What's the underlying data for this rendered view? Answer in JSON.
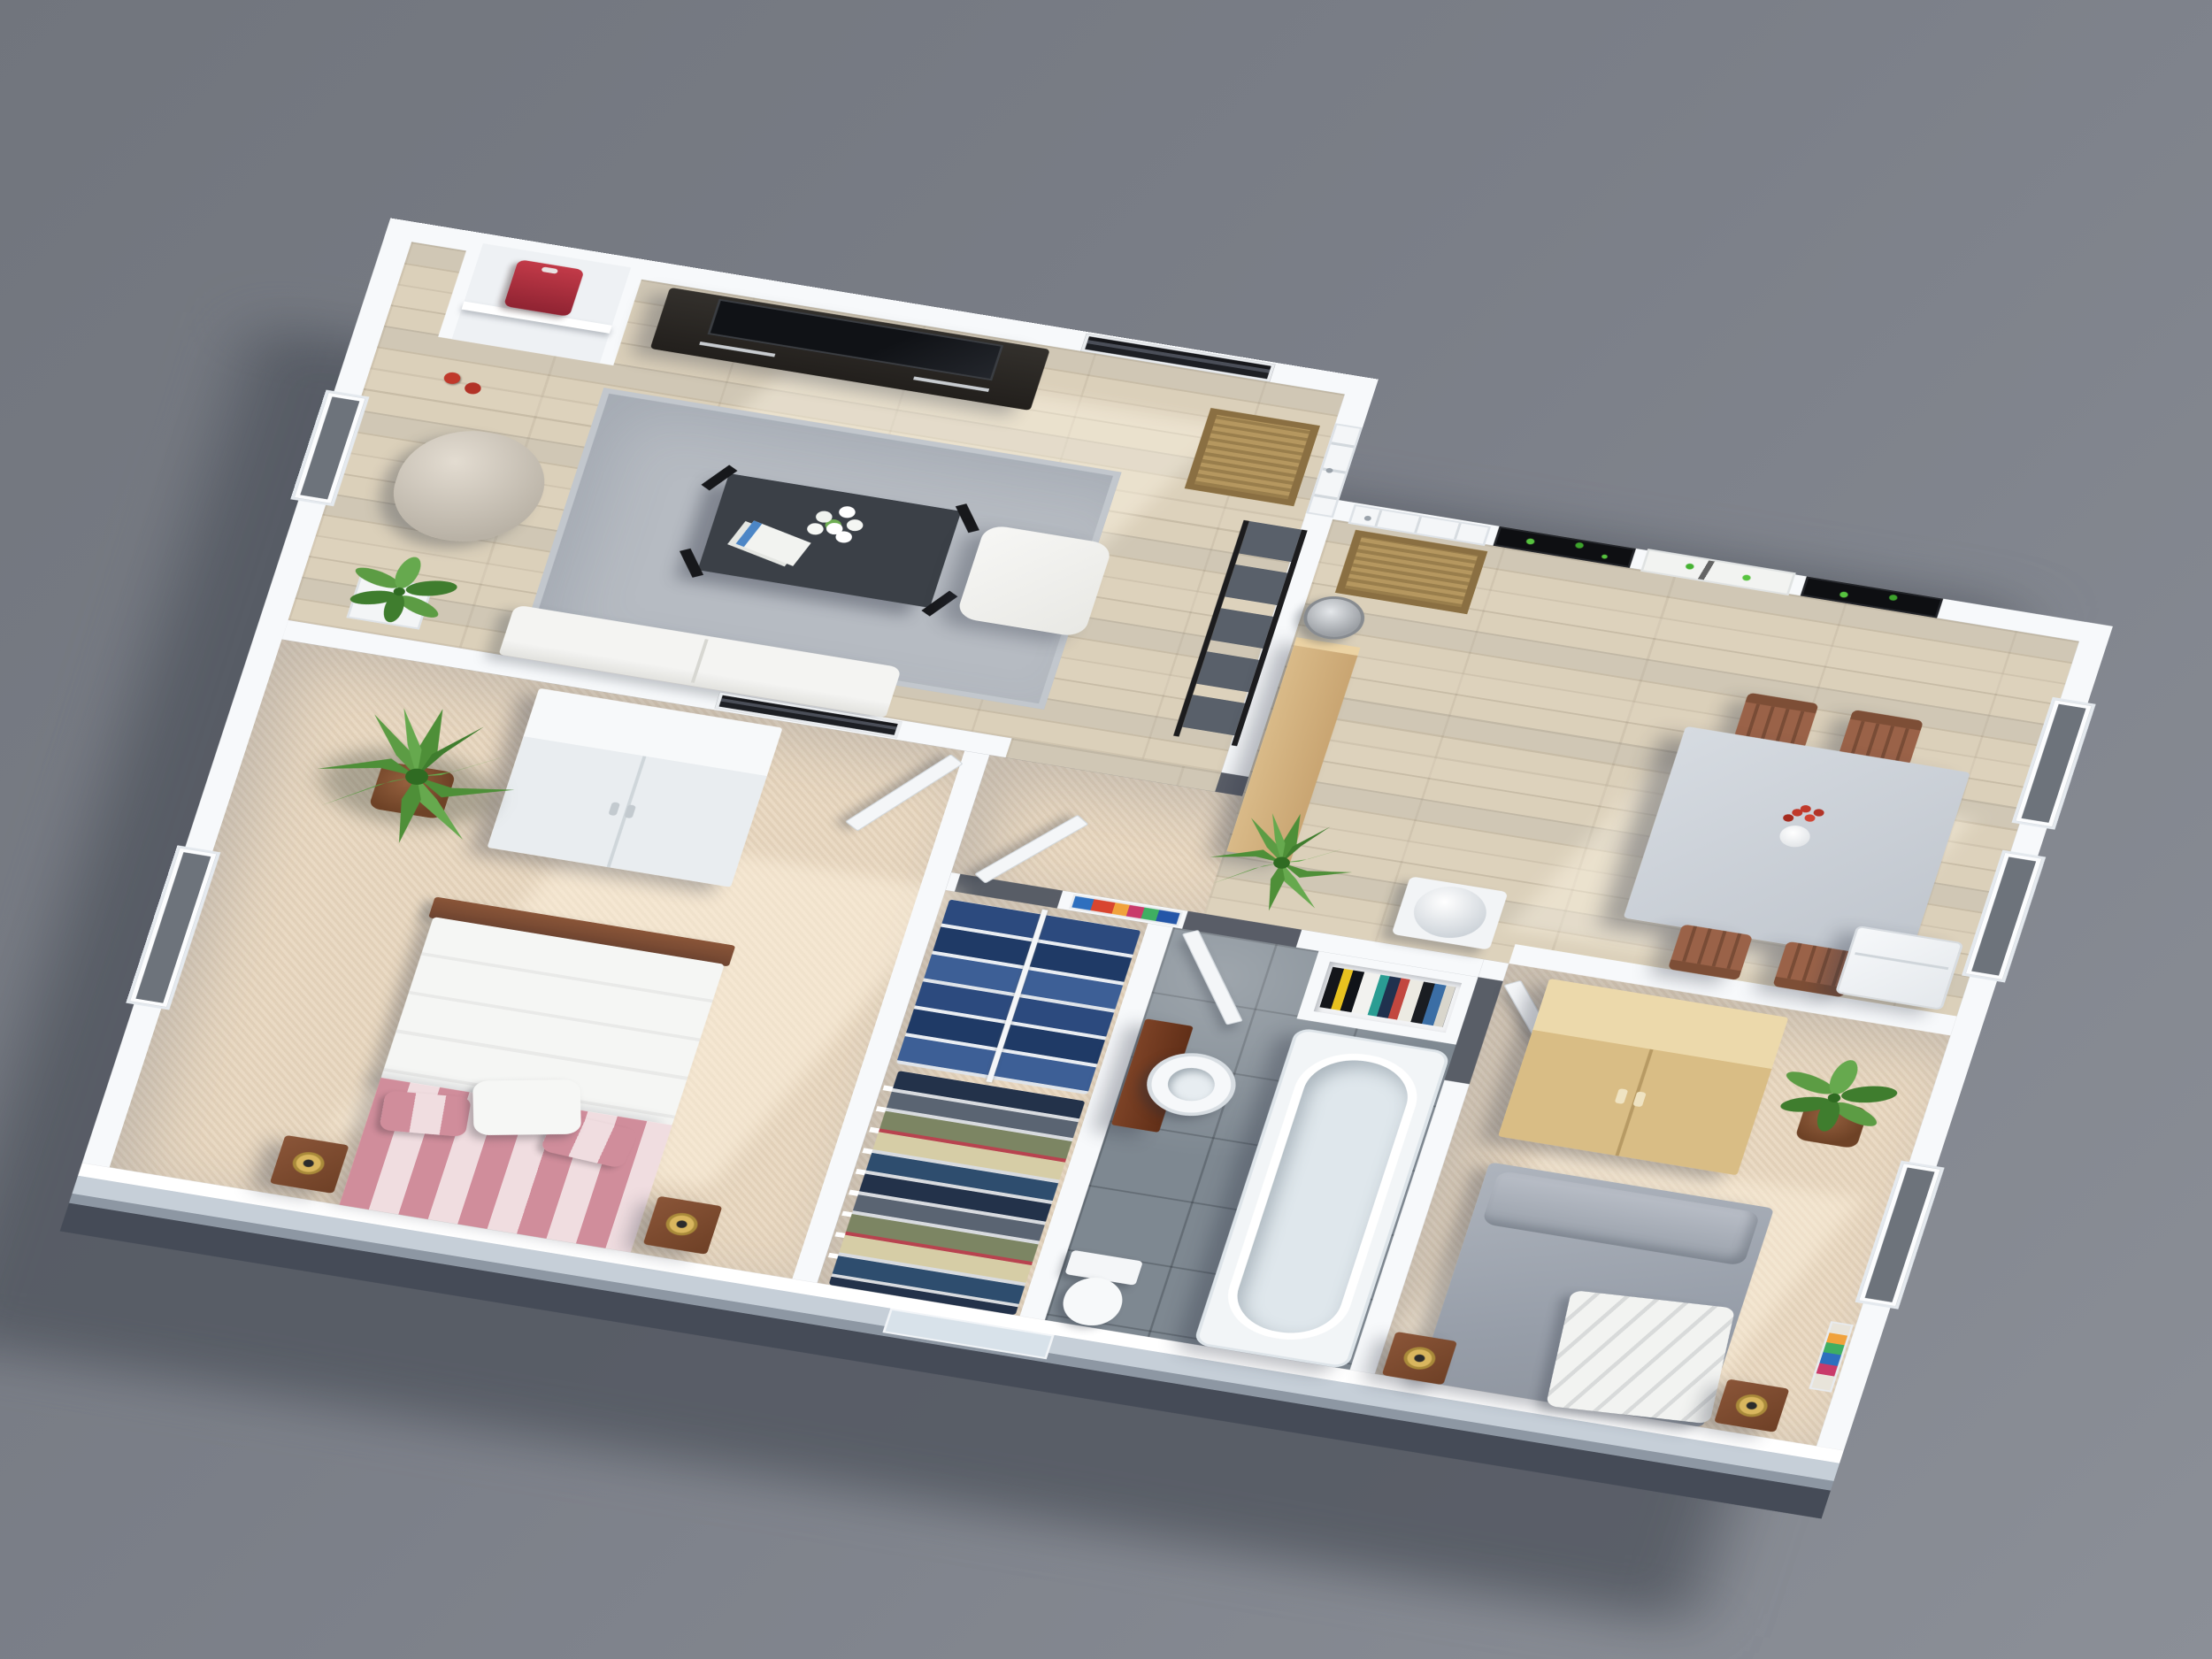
{
  "scene": {
    "description": "3D isometric render of a furnished two-bedroom apartment floor plan viewed from above, white walls, gray background, shadow cast to the lower left",
    "view": "top-down axonometric, rotated clockwise ~13 degrees, tilted ~45 degrees"
  },
  "palette": {
    "bg-top": "#71757d",
    "bg-bottom": "#8b8f97",
    "building-shadow": "#51565f",
    "wall": "#f7f9fb",
    "wall-face-light": "#c6cfd8",
    "wall-face-dark": "#454b57",
    "wood-floor": "#dbd0ba",
    "carpet": "#e8d7bf",
    "tile": "#7e8891",
    "rug": "#b6bbc2",
    "birch": "#d9ba88",
    "dark-furniture": "#282521",
    "door-white": "#f4f6f8",
    "glass": "#6d737b",
    "doormat": "#b5975f",
    "bed-stripe-pink": "#d08d9b",
    "bed2-gray": "#a7adb6",
    "plant-green": "#4e8f38",
    "accent-red": "#b02f3e",
    "gold": "#d9b65e",
    "headboard-wood": "#6e4430"
  },
  "rooms": [
    {
      "id": "living-room",
      "floor": "light oak planks",
      "contents": [
        "wall-niche with red shirt on shelf",
        "red spray cans",
        "tv-stand",
        "flat-tv",
        "black-white city picture",
        "white interior door with doormat",
        "ladder shelf",
        "beanbag",
        "gray area rug",
        "glass coffee table",
        "white lily bouquet",
        "magazines",
        "white ottoman",
        "white sofa",
        "small plant in white planter"
      ]
    },
    {
      "id": "dining-room",
      "floor": "light oak planks",
      "contents": [
        "white front door with doormat",
        "tree triptych wall art (black-white-black panels, green leaves)",
        "gray dining table",
        "4 wooden chairs",
        "vase with red flowers",
        "birch kitchen counter",
        "metal trash bin",
        "white water heater cylinder",
        "white fridge",
        "2 windows on east wall"
      ]
    },
    {
      "id": "hallway",
      "floor": "beige carpet",
      "contents": [
        "colorful abstract harbor painting",
        "spiky yucca plant",
        "open white doors"
      ]
    },
    {
      "id": "bedroom-1",
      "floor": "beige carpet",
      "contents": [
        "white wardrobe",
        "potted yucca",
        "black-white city picture",
        "double bed with white duvet and pink striped foot",
        "wood headboard",
        "2 wood nightstands",
        "2 gold lamps",
        "west window"
      ]
    },
    {
      "id": "closet",
      "floor": "beige carpet",
      "contents": [
        "wire shelving",
        "hanging blue shirts on rail",
        "stacks of folded clothes"
      ]
    },
    {
      "id": "bathroom",
      "floor": "dark gray tiles",
      "contents": [
        "brown vanity with round white sink",
        "toilet",
        "white bathtub",
        "wall niche with colorful books and towels",
        "open door"
      ]
    },
    {
      "id": "bedroom-2",
      "floor": "beige carpet",
      "contents": [
        "birch wardrobe",
        "potted ficus",
        "bed with gray duvet and white throw",
        "2 wood nightstands",
        "2 gold lamps",
        "east window",
        "small colorful artwork"
      ]
    }
  ],
  "exterior": {
    "south_wall_window": "small window opening in front wall near bathroom",
    "west_wall_windows": 2,
    "east_wall_windows": 3
  }
}
